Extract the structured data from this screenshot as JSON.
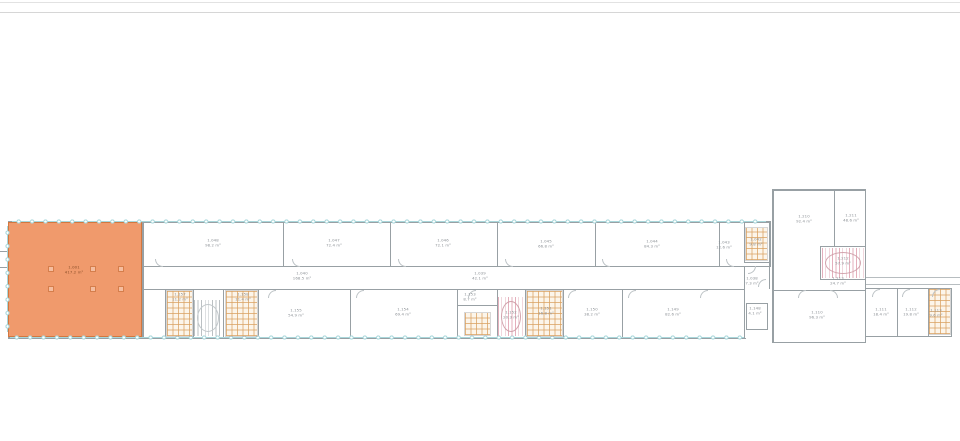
{
  "colors": {
    "highlight_fill": "#F09A6C",
    "highlight_border": "#D2773F",
    "window_teal": "#A9D7DB",
    "stair_pink": "#E2ABB8",
    "wall_gray": "#98A0A4",
    "text_gray": "#8A8F94",
    "rule_light": "#E2E2E2",
    "rule_dark": "#D6D6D6"
  },
  "highlight_room": {
    "number": "1.001",
    "area": "417.2 m²"
  },
  "rooms": [
    {
      "name": "highlighted-room-label",
      "cx": 74,
      "cy": 270,
      "lines": [
        "1.001",
        "417.2 m²"
      ],
      "cls": "on-orange"
    },
    {
      "name": "room-label",
      "cx": 213,
      "cy": 243,
      "lines": [
        "1.048",
        "98.2 m²"
      ]
    },
    {
      "name": "room-label",
      "cx": 334,
      "cy": 243,
      "lines": [
        "1.047",
        "72.4 m²"
      ]
    },
    {
      "name": "room-label",
      "cx": 443,
      "cy": 243,
      "lines": [
        "1.046",
        "72.1 m²"
      ]
    },
    {
      "name": "room-label",
      "cx": 546,
      "cy": 244,
      "lines": [
        "1.045",
        "66.8 m²"
      ]
    },
    {
      "name": "room-label",
      "cx": 652,
      "cy": 244,
      "lines": [
        "1.044",
        "84.3 m²"
      ]
    },
    {
      "name": "room-label",
      "cx": 724,
      "cy": 245,
      "lines": [
        "1.043",
        "12.6 m²"
      ]
    },
    {
      "name": "room-label",
      "cx": 756,
      "cy": 242,
      "lines": [
        "1.042",
        "9.8 m²"
      ]
    },
    {
      "name": "corridor-label",
      "cx": 302,
      "cy": 276,
      "lines": [
        "1.040",
        "168.5 m²"
      ]
    },
    {
      "name": "corridor-label",
      "cx": 480,
      "cy": 276,
      "lines": [
        "1.039",
        "42.1 m²"
      ]
    },
    {
      "name": "corridor-label",
      "cx": 752,
      "cy": 281,
      "lines": [
        "1.038",
        "7.3 m²"
      ]
    },
    {
      "name": "room-label",
      "cx": 180,
      "cy": 297,
      "lines": [
        "1.157",
        "11.2 m²"
      ]
    },
    {
      "name": "room-label",
      "cx": 243,
      "cy": 297,
      "lines": [
        "1.158",
        "11.4 m²"
      ]
    },
    {
      "name": "room-label",
      "cx": 296,
      "cy": 313,
      "lines": [
        "1.155",
        "54.9 m²"
      ]
    },
    {
      "name": "room-label",
      "cx": 403,
      "cy": 312,
      "lines": [
        "1.154",
        "69.4 m²"
      ]
    },
    {
      "name": "room-label",
      "cx": 470,
      "cy": 297,
      "lines": [
        "1.153",
        "8.7 m²"
      ]
    },
    {
      "name": "stair-label",
      "cx": 511,
      "cy": 315,
      "lines": [
        "1.152",
        "20.3 m²"
      ]
    },
    {
      "name": "room-label",
      "cx": 546,
      "cy": 311,
      "lines": [
        "1.151",
        "16.8 m²"
      ]
    },
    {
      "name": "room-label",
      "cx": 592,
      "cy": 312,
      "lines": [
        "1.150",
        "38.2 m²"
      ]
    },
    {
      "name": "room-label",
      "cx": 673,
      "cy": 312,
      "lines": [
        "1.149",
        "82.6 m²"
      ]
    },
    {
      "name": "lift-label",
      "cx": 755,
      "cy": 311,
      "lines": [
        "1.148",
        "4.1 m²"
      ]
    },
    {
      "name": "room-label",
      "cx": 804,
      "cy": 219,
      "lines": [
        "1.210",
        "92.4 m²"
      ]
    },
    {
      "name": "room-label",
      "cx": 851,
      "cy": 218,
      "lines": [
        "1.211",
        "48.6 m²"
      ]
    },
    {
      "name": "stair-label",
      "cx": 843,
      "cy": 261,
      "lines": [
        "1.212",
        "57.9 m²"
      ]
    },
    {
      "name": "corridor-label",
      "cx": 838,
      "cy": 281,
      "lines": [
        "1.213",
        "24.7 m²"
      ]
    },
    {
      "name": "room-label",
      "cx": 817,
      "cy": 315,
      "lines": [
        "1.110",
        "96.3 m²"
      ]
    },
    {
      "name": "room-label",
      "cx": 881,
      "cy": 312,
      "lines": [
        "1.111",
        "18.4 m²"
      ]
    },
    {
      "name": "room-label",
      "cx": 911,
      "cy": 312,
      "lines": [
        "1.112",
        "19.8 m²"
      ]
    },
    {
      "name": "room-label",
      "cx": 936,
      "cy": 313,
      "lines": [
        "1.113",
        "9.6 m²"
      ]
    }
  ],
  "walls": [
    {
      "x": 8,
      "y": 221,
      "w": 762,
      "h": 1.5
    },
    {
      "x": 8,
      "y": 221,
      "w": 1.5,
      "h": 118
    },
    {
      "x": 8,
      "y": 337.5,
      "w": 738,
      "h": 1.5
    },
    {
      "x": 142,
      "y": 221,
      "w": 1.5,
      "h": 117
    },
    {
      "x": 143,
      "y": 265.5,
      "w": 628,
      "h": 1
    },
    {
      "x": 143,
      "y": 288.5,
      "w": 602,
      "h": 1
    },
    {
      "x": 283,
      "y": 222,
      "w": 1,
      "h": 44
    },
    {
      "x": 390,
      "y": 222,
      "w": 1,
      "h": 44
    },
    {
      "x": 497,
      "y": 222,
      "w": 1,
      "h": 44
    },
    {
      "x": 595,
      "y": 222,
      "w": 1,
      "h": 44
    },
    {
      "x": 719,
      "y": 222,
      "w": 1,
      "h": 44
    },
    {
      "x": 744,
      "y": 222,
      "w": 1,
      "h": 41
    },
    {
      "x": 744,
      "y": 262,
      "w": 26,
      "h": 1
    },
    {
      "x": 769,
      "y": 221,
      "w": 1.5,
      "h": 46
    },
    {
      "x": 744,
      "y": 266,
      "w": 1,
      "h": 23
    },
    {
      "x": 769,
      "y": 266,
      "w": 1,
      "h": 23
    },
    {
      "x": 165,
      "y": 289,
      "w": 1,
      "h": 49
    },
    {
      "x": 193,
      "y": 289,
      "w": 1,
      "h": 49
    },
    {
      "x": 223,
      "y": 289,
      "w": 1,
      "h": 49
    },
    {
      "x": 258,
      "y": 289,
      "w": 1,
      "h": 49
    },
    {
      "x": 350,
      "y": 289,
      "w": 1,
      "h": 49
    },
    {
      "x": 457,
      "y": 289,
      "w": 1,
      "h": 49
    },
    {
      "x": 497,
      "y": 289,
      "w": 1,
      "h": 49
    },
    {
      "x": 525,
      "y": 289,
      "w": 1,
      "h": 49
    },
    {
      "x": 563,
      "y": 289,
      "w": 1,
      "h": 49
    },
    {
      "x": 622,
      "y": 289,
      "w": 1,
      "h": 49
    },
    {
      "x": 457,
      "y": 305,
      "w": 40,
      "h": 1
    },
    {
      "x": 744,
      "y": 289,
      "w": 1,
      "h": 49
    },
    {
      "x": 746,
      "y": 303,
      "w": 22,
      "h": 1
    },
    {
      "x": 746,
      "y": 329,
      "w": 22,
      "h": 1
    },
    {
      "x": 746,
      "y": 303,
      "w": 1,
      "h": 26
    },
    {
      "x": 767,
      "y": 303,
      "w": 1,
      "h": 26
    },
    {
      "x": 772,
      "y": 189,
      "w": 94,
      "h": 1.5
    },
    {
      "x": 772,
      "y": 189,
      "w": 1.5,
      "h": 154
    },
    {
      "x": 864.5,
      "y": 189,
      "w": 1.5,
      "h": 92
    },
    {
      "x": 864.5,
      "y": 281,
      "w": 1.5,
      "h": 61
    },
    {
      "x": 772,
      "y": 341.5,
      "w": 94,
      "h": 1.5
    },
    {
      "x": 834,
      "y": 190,
      "w": 1,
      "h": 57
    },
    {
      "x": 820,
      "y": 246,
      "w": 45,
      "h": 1
    },
    {
      "x": 820,
      "y": 279,
      "w": 45,
      "h": 1
    },
    {
      "x": 820,
      "y": 246,
      "w": 1,
      "h": 34
    },
    {
      "x": 773,
      "y": 289.5,
      "w": 92,
      "h": 1
    },
    {
      "x": 866,
      "y": 287.5,
      "w": 86,
      "h": 1
    },
    {
      "x": 866,
      "y": 335.5,
      "w": 86,
      "h": 1.5
    },
    {
      "x": 950.5,
      "y": 287.5,
      "w": 1.5,
      "h": 49
    },
    {
      "x": 897,
      "y": 288,
      "w": 1,
      "h": 48
    },
    {
      "x": 928,
      "y": 288,
      "w": 1,
      "h": 48
    },
    {
      "x": 866,
      "y": 276.5,
      "w": 94,
      "h": 1,
      "lt": true
    },
    {
      "x": 866,
      "y": 283.5,
      "w": 94,
      "h": 1,
      "lt": true
    },
    {
      "x": 0,
      "y": 251,
      "w": 8,
      "h": 1
    },
    {
      "x": 0,
      "y": 267,
      "w": 8,
      "h": 1
    }
  ],
  "windows": [
    {
      "o": "h",
      "x": 12,
      "y": 218,
      "len": 754
    },
    {
      "o": "h",
      "x": 10,
      "y": 334,
      "len": 734
    },
    {
      "o": "v",
      "x": 4,
      "y": 226,
      "len": 106
    }
  ],
  "stairwells": [
    {
      "name": "stairwell",
      "type": "g",
      "x": 194,
      "y": 300,
      "w": 28,
      "h": 36
    },
    {
      "name": "stairwell",
      "type": "p",
      "x": 498,
      "y": 297,
      "w": 26,
      "h": 39
    },
    {
      "name": "stairwell",
      "type": "p",
      "x": 822,
      "y": 248,
      "w": 42,
      "h": 30
    }
  ],
  "fixture_zones": [
    {
      "name": "washroom-fixtures",
      "x": 746,
      "y": 228,
      "w": 21,
      "h": 32
    },
    {
      "name": "washroom-fixtures",
      "x": 167,
      "y": 291,
      "w": 25,
      "h": 45
    },
    {
      "name": "washroom-fixtures",
      "x": 226,
      "y": 291,
      "w": 31,
      "h": 45
    },
    {
      "name": "washroom-fixtures",
      "x": 465,
      "y": 313,
      "w": 25,
      "h": 22
    },
    {
      "name": "washroom-fixtures",
      "x": 527,
      "y": 291,
      "w": 35,
      "h": 45
    },
    {
      "name": "washroom-fixtures",
      "x": 929,
      "y": 289,
      "w": 21,
      "h": 45
    }
  ],
  "doors": [
    {
      "x": 155,
      "y": 258.5,
      "dir": "sw"
    },
    {
      "x": 292,
      "y": 258.5,
      "dir": "sw"
    },
    {
      "x": 398,
      "y": 258.5,
      "dir": "sw"
    },
    {
      "x": 505,
      "y": 258.5,
      "dir": "sw"
    },
    {
      "x": 602,
      "y": 258.5,
      "dir": "sw"
    },
    {
      "x": 726,
      "y": 258.5,
      "dir": "sw"
    },
    {
      "x": 268,
      "y": 289.5,
      "dir": "nw"
    },
    {
      "x": 356,
      "y": 289.5,
      "dir": "nw"
    },
    {
      "x": 468,
      "y": 289.5,
      "dir": "nw"
    },
    {
      "x": 568,
      "y": 289.5,
      "dir": "nw"
    },
    {
      "x": 628,
      "y": 289.5,
      "dir": "nw"
    },
    {
      "x": 700,
      "y": 289.5,
      "dir": "nw"
    },
    {
      "x": 748,
      "y": 266,
      "dir": "se"
    },
    {
      "x": 758,
      "y": 279,
      "dir": "nw"
    },
    {
      "x": 798,
      "y": 290,
      "dir": "nw"
    },
    {
      "x": 830,
      "y": 290,
      "dir": "ne"
    },
    {
      "x": 872,
      "y": 289,
      "dir": "nw"
    },
    {
      "x": 902,
      "y": 289,
      "dir": "nw"
    },
    {
      "x": 932,
      "y": 289,
      "dir": "nw"
    }
  ],
  "columns": [
    {
      "x": 48,
      "y": 266
    },
    {
      "x": 90,
      "y": 266
    },
    {
      "x": 118,
      "y": 266
    },
    {
      "x": 48,
      "y": 286
    },
    {
      "x": 90,
      "y": 286
    },
    {
      "x": 118,
      "y": 286
    }
  ],
  "rules": [
    {
      "y": 1.5,
      "h": 1,
      "tone": "rule_light"
    },
    {
      "y": 11.5,
      "h": 1.2,
      "tone": "rule_dark"
    }
  ]
}
